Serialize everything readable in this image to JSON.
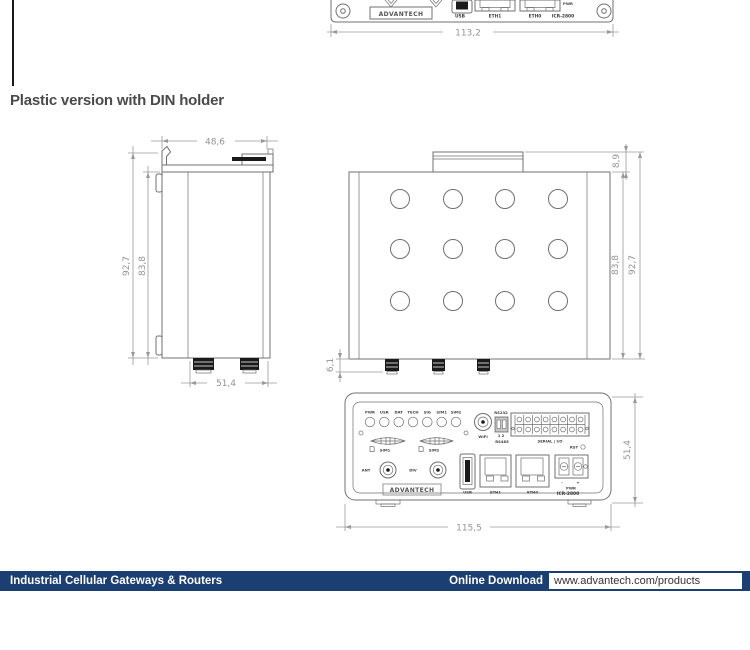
{
  "page": {
    "heading": "Plastic version with DIN holder"
  },
  "colors": {
    "footer_bar": "#1b3f72",
    "drawing_line": "#707070",
    "dimension": "#9a9a9a"
  },
  "top_drawing": {
    "logo": "ADVANTECH",
    "usb": "USB",
    "eth1": "ETH1",
    "eth0": "ETH0",
    "model": "ICR-2800",
    "pwr": "PWR",
    "dim_width": "113,2"
  },
  "side_view": {
    "dim_top_width": "48,6",
    "dim_height_outer": "92,7",
    "dim_height_inner": "83,8",
    "dim_bottom_depth": "51,4"
  },
  "top_view": {
    "dim_din_tab": "8,9",
    "dim_height_inner": "83,8",
    "dim_height_outer": "92,7",
    "dim_antenna": "6,1"
  },
  "front_view": {
    "leds": [
      "PWR",
      "USR",
      "DAT",
      "TECH",
      "SIG",
      "SIM1",
      "SIM2"
    ],
    "wifi": "WIFI",
    "rs232": "RS232",
    "dip": "1 2",
    "rs485": "RS485",
    "serial_io": "SERIAL | I/O",
    "rst": "RST",
    "sim1": "SIM1",
    "sim2": "SIM2",
    "ant": "ANT",
    "div": "DIV",
    "usb": "USB",
    "eth1": "ETH1",
    "eth0": "ETH0",
    "minus": "-",
    "plus": "+",
    "pwr": "PWR",
    "model": "ICR-2800",
    "logo": "ADVANTECH",
    "dim_width": "115,5",
    "dim_height": "51,4"
  },
  "footer": {
    "left_text": "Industrial Cellular Gateways & Routers",
    "download_label": "Online Download",
    "url": "www.advantech.com/products"
  }
}
